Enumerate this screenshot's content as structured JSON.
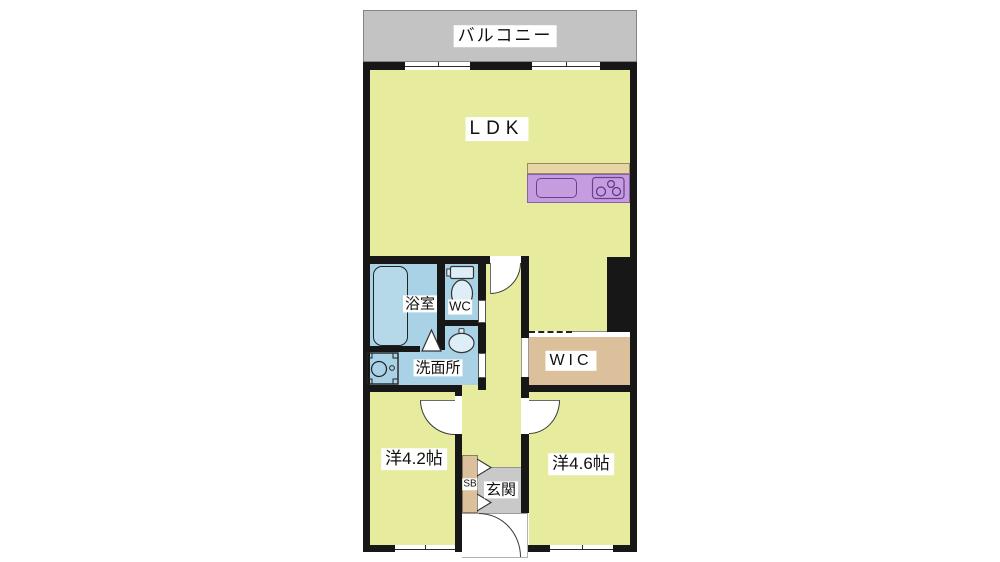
{
  "plan_title": "apartment-floor-plan",
  "colors": {
    "floor": "#e7eb9e",
    "water": "#a9d2e6",
    "tan": "#dcc09b",
    "purple": "#c59ddf",
    "countertop": "#e8d5a5",
    "balcony": "#c3c3c3",
    "genkan": "#c9c9c9",
    "wall": "#171717",
    "label_bg": "#ffffff"
  },
  "rooms": {
    "balcony": {
      "label": "バルコニー"
    },
    "ldk": {
      "label": "LDK"
    },
    "bathroom": {
      "label": "浴室"
    },
    "toilet": {
      "label": "WC"
    },
    "washroom": {
      "label": "洗面所"
    },
    "wic": {
      "label": "WIC"
    },
    "western_room_1": {
      "label": "洋4.2帖"
    },
    "western_room_2": {
      "label": "洋4.6帖"
    },
    "shoe_box": {
      "label": "SB"
    },
    "entrance": {
      "label": "玄関"
    }
  }
}
